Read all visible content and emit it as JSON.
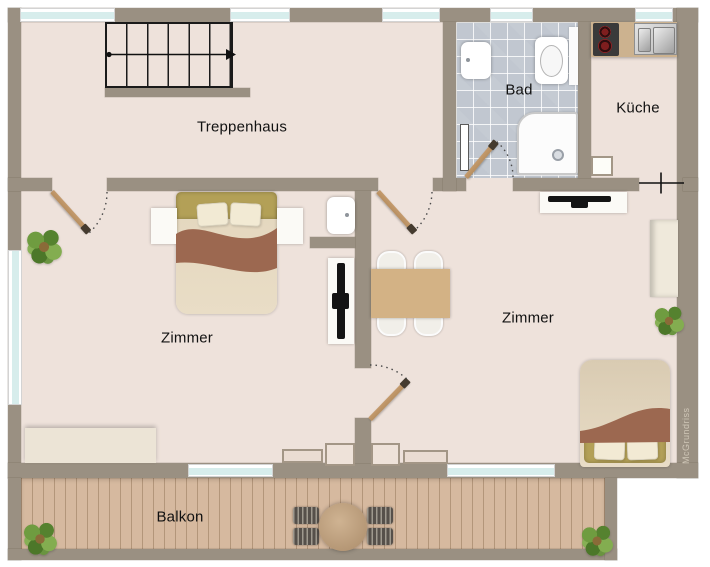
{
  "watermark": {
    "label": "McGrundriss"
  },
  "rooms": {
    "treppenhaus": {
      "label": "Treppenhaus"
    },
    "bad": {
      "label": "Bad"
    },
    "kueche": {
      "label": "Küche"
    },
    "zimmer_links": {
      "label": "Zimmer"
    },
    "zimmer_rechts": {
      "label": "Zimmer"
    },
    "balkon": {
      "label": "Balkon"
    }
  },
  "colors": {
    "wall": "#9a9082",
    "floor": "#eee2db",
    "tile": "#c1c7d0",
    "deck": "#d6b99f",
    "window_glass": "#d7edec",
    "door_leaf": "#b78f61",
    "blanket": "#9c6850",
    "headboard": "#b3a057",
    "table_wood": "#d3b285",
    "text": "#111111"
  },
  "furniture": {
    "treppenhaus": [
      "staircase-up-arrow"
    ],
    "bad": [
      "toilet",
      "washbasin",
      "shower",
      "towel-radiator",
      "door-swing"
    ],
    "kueche": [
      "stove-two-burners",
      "double-sink",
      "counter",
      "wall-niche",
      "door-symbol"
    ],
    "zimmer_links": [
      "double-bed",
      "nightstand-left",
      "nightstand-right",
      "wall-basin",
      "tv-board",
      "sideboard",
      "radiator",
      "plant",
      "door-swing"
    ],
    "zimmer_rechts": [
      "dining-table",
      "four-chairs",
      "tv-sideboard",
      "wardrobe",
      "double-bed",
      "radiator",
      "plant",
      "door-swing"
    ],
    "balkon": [
      "round-table",
      "four-chairs",
      "plant-left",
      "plant-right"
    ]
  }
}
